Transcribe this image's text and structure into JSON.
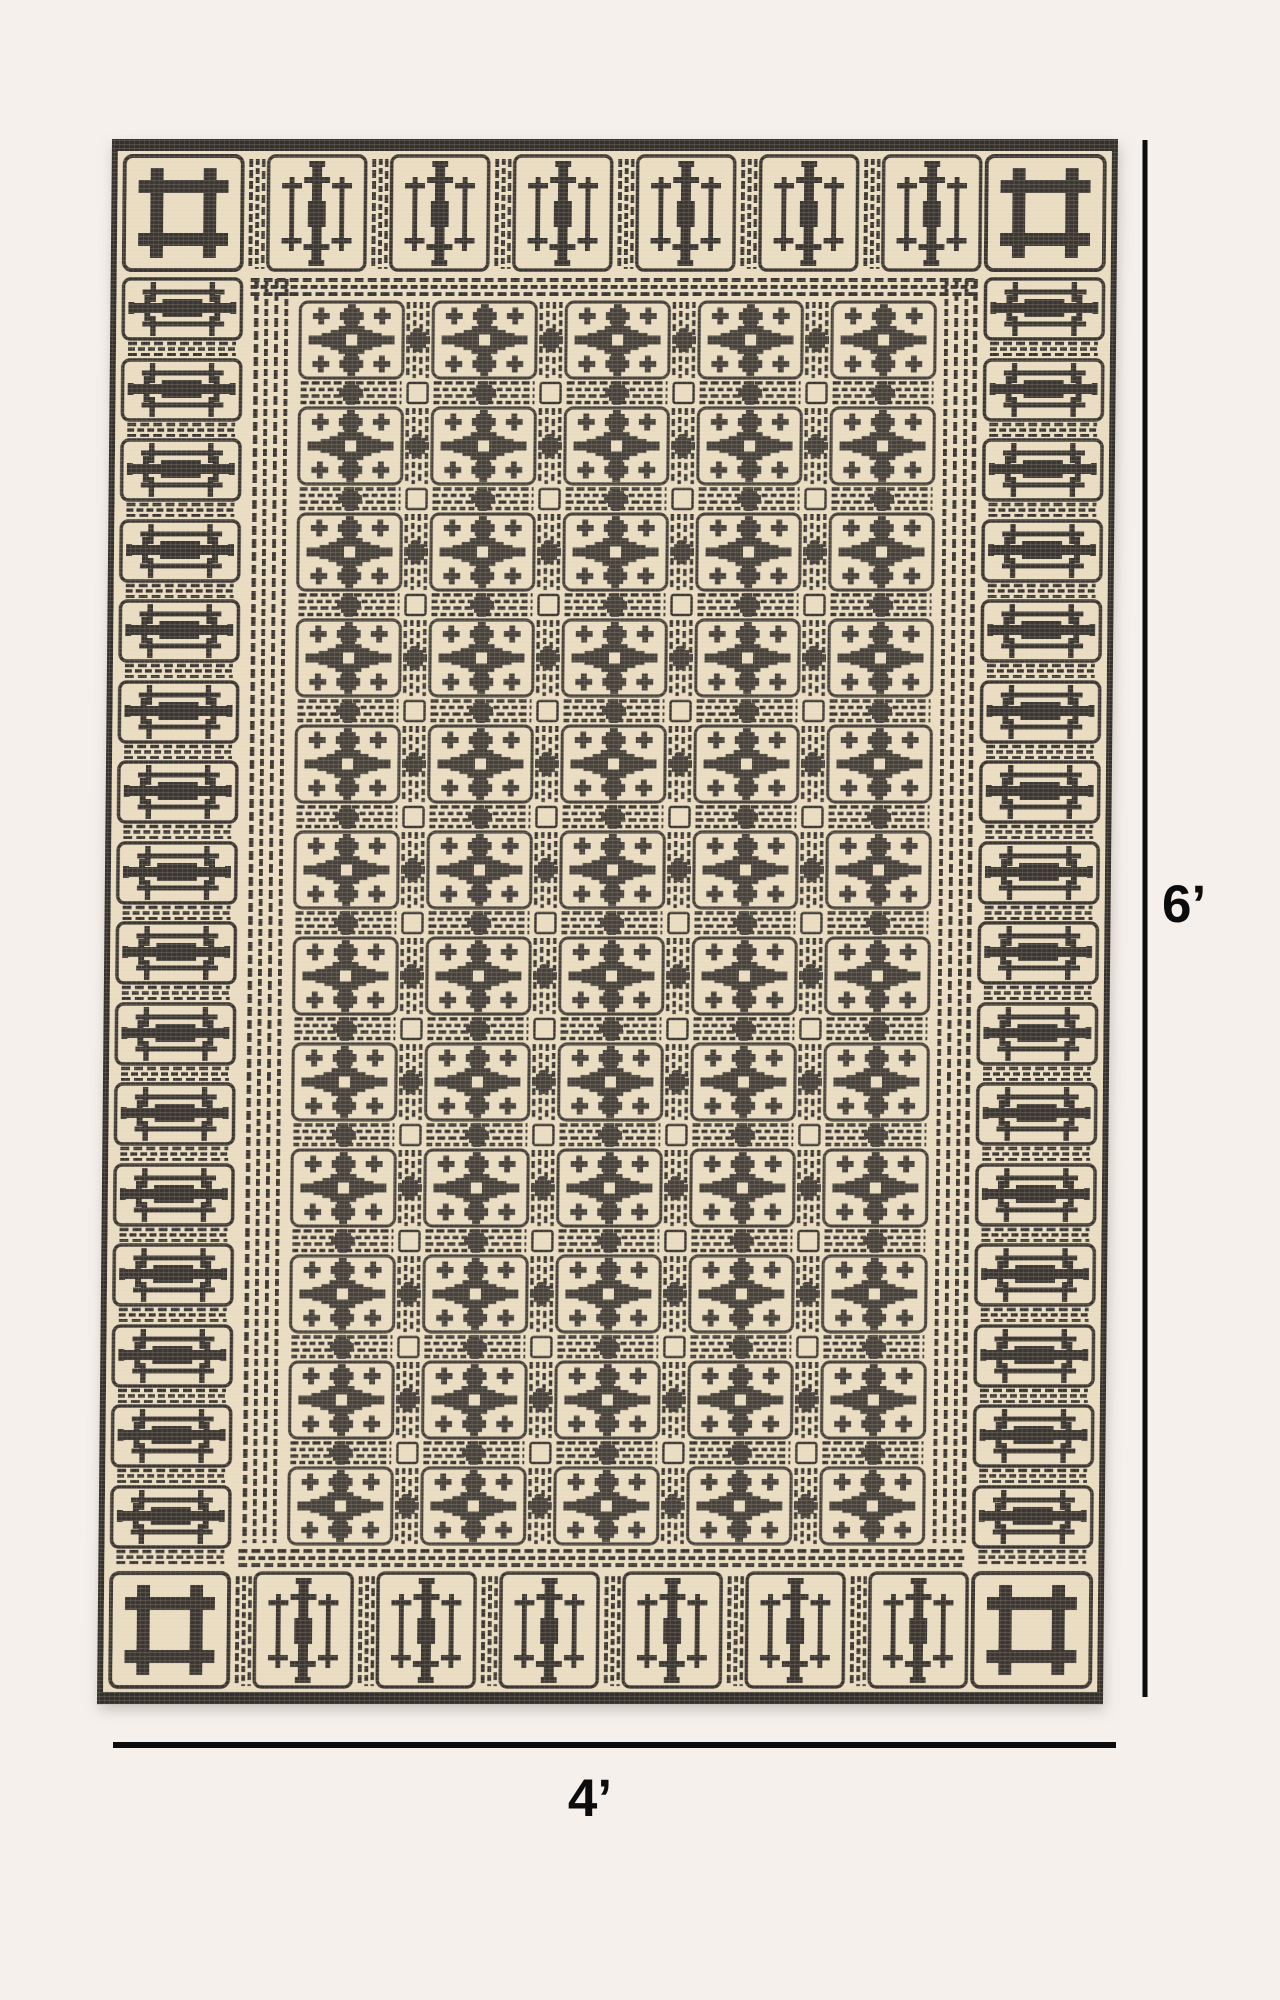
{
  "page": {
    "background_color": "#f5f0eb"
  },
  "rug": {
    "description": "Cream and charcoal hand block-printed geometric flatweave rug viewed from above",
    "base_color": "#e9dcc0",
    "ink_color": "#3a3531",
    "field_ink_color": "#46413b",
    "motifs": {
      "corner": "open-square-frame-motif",
      "top_bottom_border": "triple-vertical-bar-motif",
      "left_right_border": "triple-horizontal-bar-motif",
      "field": "stepped-cross-medallion-grid"
    }
  },
  "dimensions": {
    "height_label": "6’",
    "width_label": "4’",
    "line_color": "#0c0c0c"
  }
}
